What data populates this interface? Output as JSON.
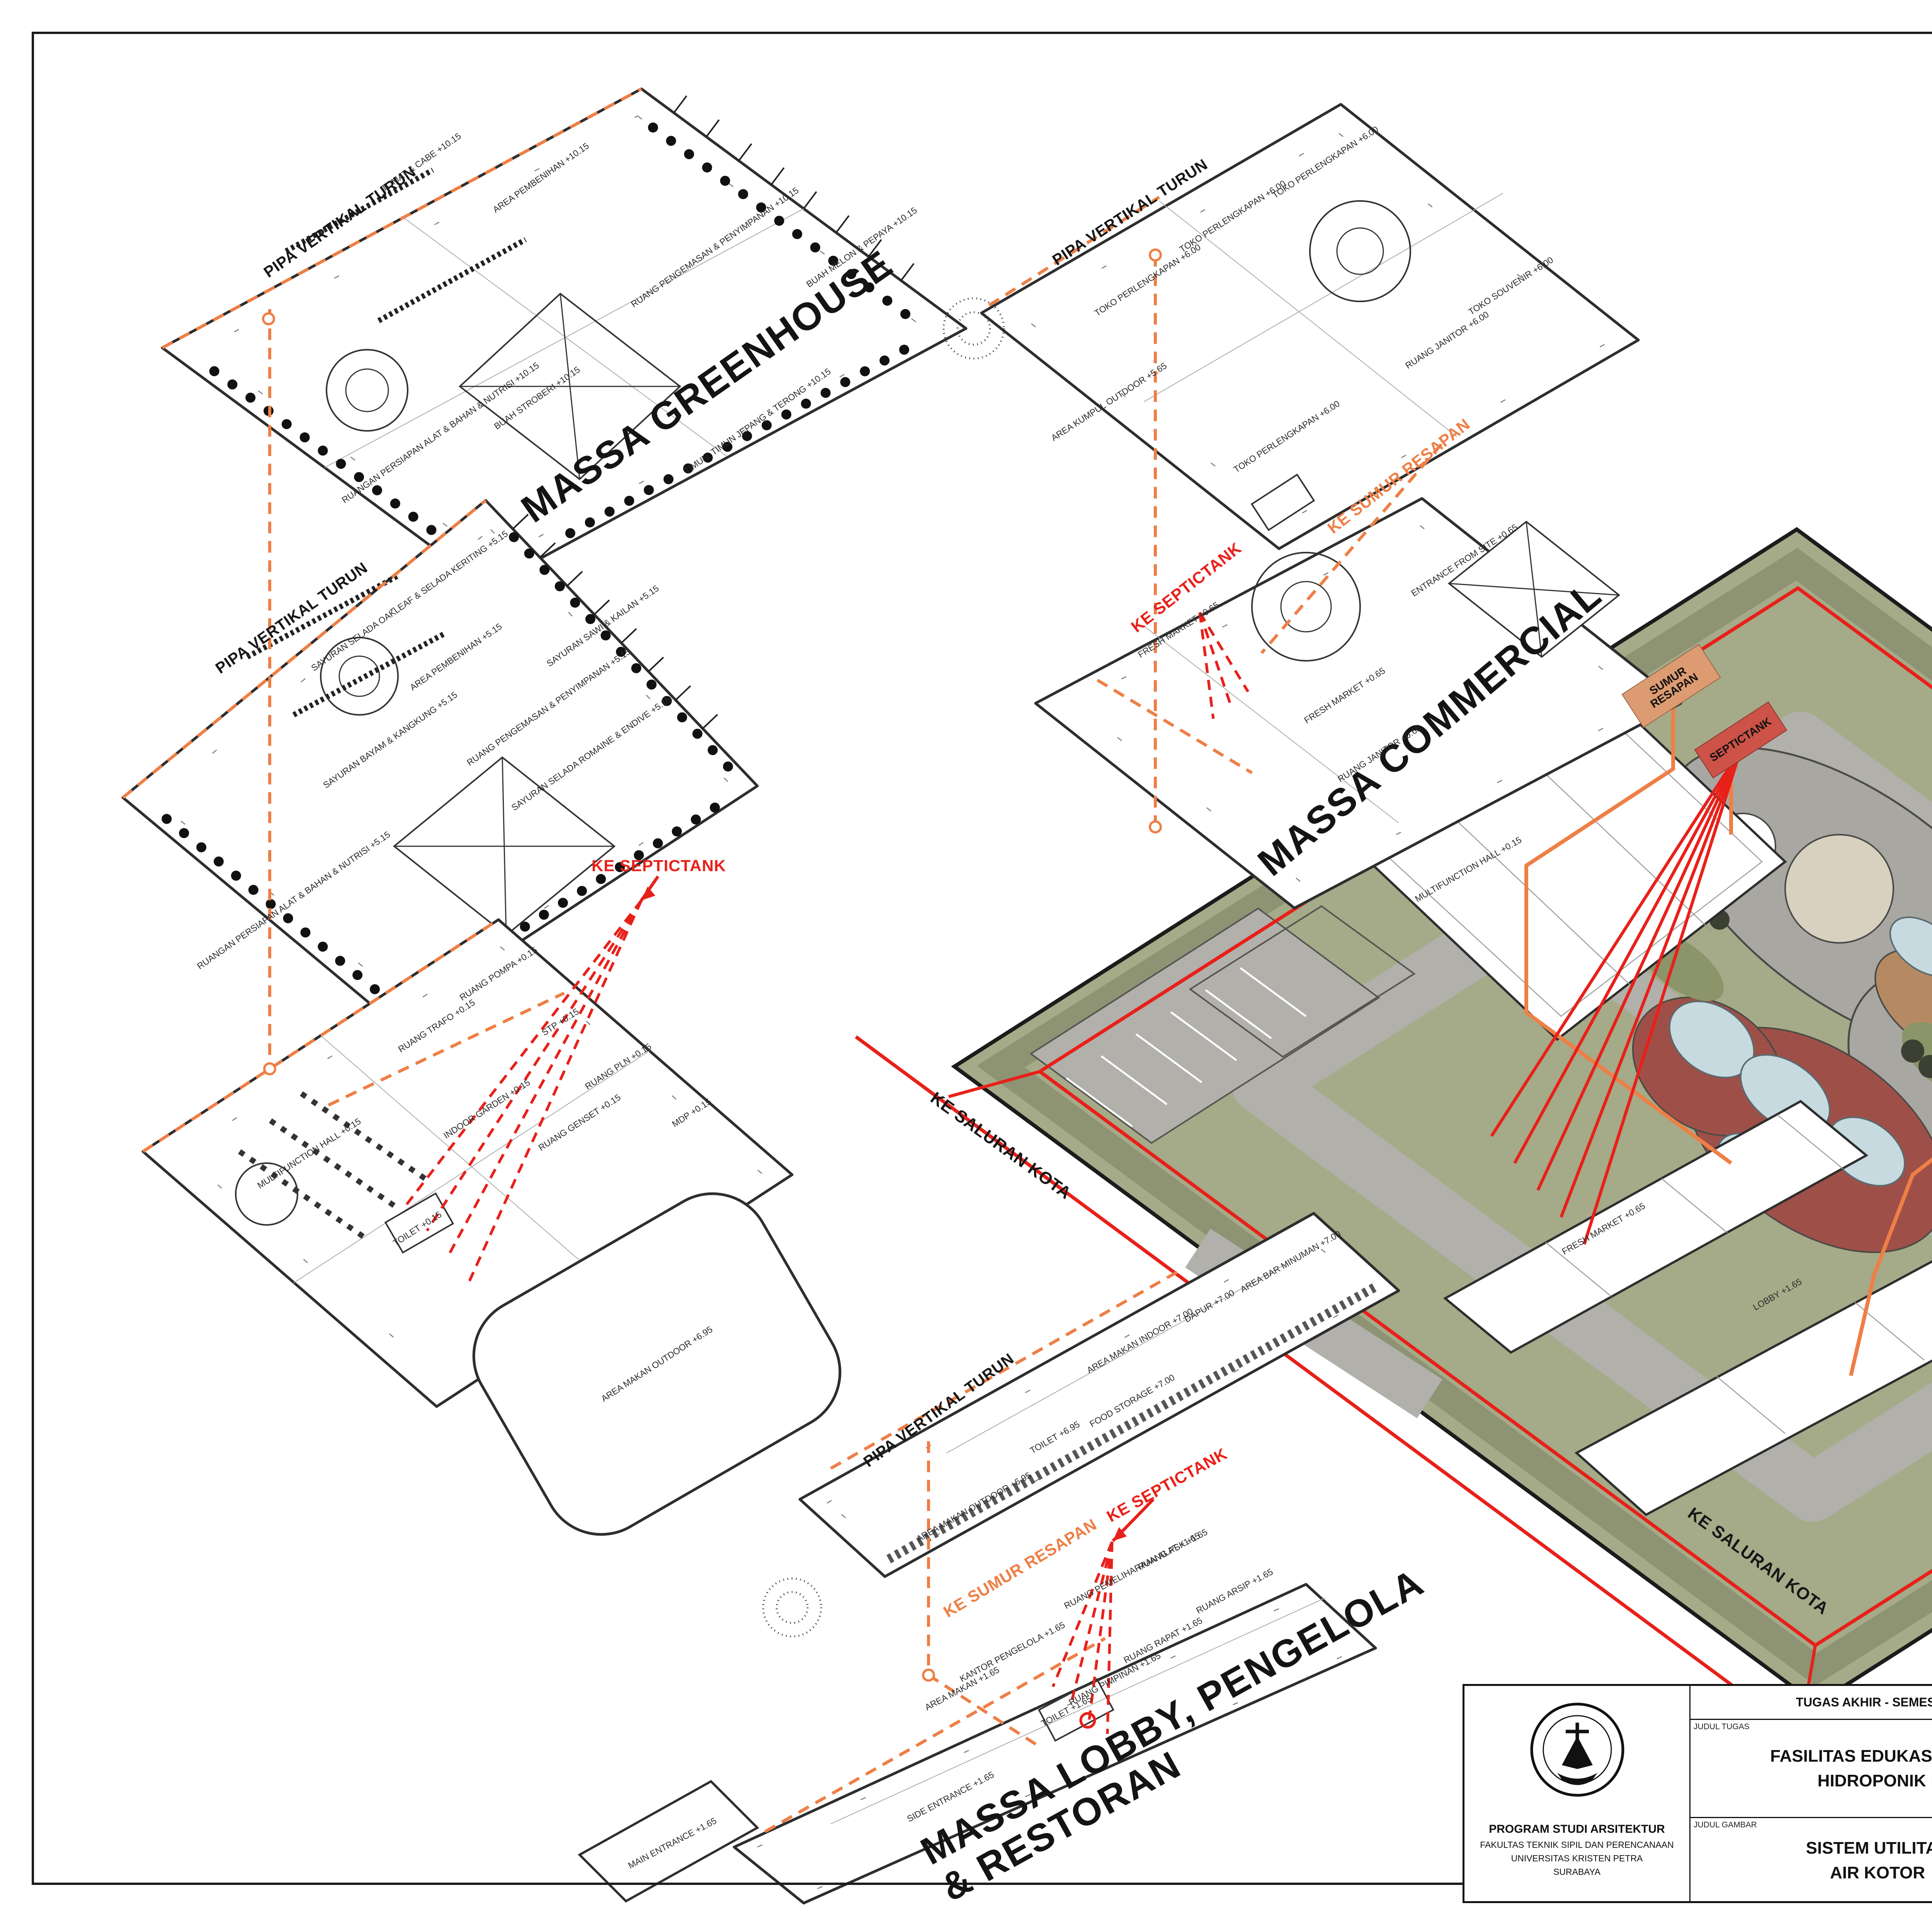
{
  "colors": {
    "accent_red": "#e8201a",
    "accent_orange": "#ee7f46",
    "site_green": "#a5aa88",
    "road_gray": "#b2b0ab",
    "plaza_red": "#9e5048",
    "pond_blue": "#c6dae0",
    "wood_tan": "#b58a63",
    "septictank_fill": "#cd5247",
    "sumur_resapan_fill": "#dd9b72"
  },
  "massa": {
    "greenhouse": "MASSA GREENHOUSE",
    "commercial": "MASSA COMMERCIAL",
    "hidroponik_line1": "MASSA HIDROPONIK",
    "hidroponik_line2": "EDUCATION",
    "lobby_line1": "MASSA LOBBY, PENGELOLA",
    "lobby_line2": "& RESTORAN"
  },
  "annotations": {
    "pipa_vertikal_turun": "PIPA VERTIKAL TURUN",
    "ke_septictank": "KE SEPTICTANK",
    "ke_sumur_resapan": "KE SUMUR RESAPAN",
    "ke_saluran_kota": "KE SALURAN KOTA",
    "septictank_box": "SEPTICTANK",
    "sumur_resapan_box": "SUMUR RESAPAN"
  },
  "plans": {
    "greenhouse_roof": {
      "rooms": [
        "RUANG PENGEMASAN & PENYIMPANAN +10.15",
        "RUANGAN PERSIAPAN ALAT & BAHAN & NUTRISI +10.15",
        "AREA PEMBENIHAN +10.15",
        "TOMAT & CABE +10.15",
        "TIMUN, TIMUN JEPANG & TERONG +10.15",
        "BUAH MELON & PEPAYA +10.15",
        "BUAH STROBERI +10.15"
      ]
    },
    "greenhouse_l2": {
      "rooms": [
        "RUANG PENGEMASAN & PENYIMPANAN +5.15",
        "RUANGAN PERSIAPAN ALAT & BAHAN & NUTRISI +5.15",
        "AREA PEMBENIHAN +5.15",
        "SAYURAN SELADA OAKLEAF & SELADA KERITING +5.15",
        "SAYURAN SAWI & KAILAN +5.15",
        "SAYURAN SELADA ROMAINE & ENDIVE +5.15",
        "SAYURAN BAYAM & KANGKUNG +5.15"
      ]
    },
    "greenhouse_l1": {
      "rooms": [
        "MULTIFUNCTION HALL +0.15",
        "INDOOR GARDEN +0.15",
        "RUANG POMPA +0.15",
        "STP +0.15",
        "RUANG TRAFO +0.15",
        "RUANG PLN +0.15",
        "MDP +0.15",
        "RUANG GENSET +0.15",
        "TOILET +0.15"
      ]
    },
    "commercial_l2": {
      "rooms": [
        "TOKO PERLENGKAPAN +6.00",
        "TOKO PERLENGKAPAN +6.00",
        "TOKO PERLENGKAPAN +6.00",
        "TOKO PERLENGKAPAN +6.00",
        "TOKO SOUVENIR +6.00",
        "RUANG JANITOR +6.00",
        "AREA KUMPUL OUTDOOR +5.65"
      ]
    },
    "commercial_l1": {
      "rooms": [
        "FRESH MARKET +0.65",
        "FRESH MARKET +0.65",
        "ENTRANCE FROM SITE +0.65",
        "RUANG JANITOR +0.65"
      ]
    },
    "education_l2": {
      "rooms": [
        "RUANG HASIL PENELITIAN +4.65",
        "LABORATORIUM +4.65",
        "PERPUSTAKAAN & RUANG BACA +4.65",
        "AHU +4.65"
      ]
    },
    "education_l1": {
      "rooms": [
        "AREA AQUAPONIC +0.15",
        "MINI GARDEN +0.15",
        "RUANG JANITOR +0.15",
        "GUDANG +0.15",
        "PERPUSTAKAAN & RUANG BACA +0.15",
        "TOILET +0.15",
        "AHU +0.15",
        "BUILDING ENTRANCE & EXIT +0.10"
      ]
    },
    "resto_l2": {
      "rooms": [
        "AREA MAKAN OUTDOOR +6.95",
        "AREA MAKAN INDOOR +7.00",
        "DAPUR +7.00",
        "AREA BAR MINUMAN +7.00",
        "FOOD STORAGE +7.00",
        "TOILET +6.95",
        "AREA MAKAN OUTDOOR +6.95"
      ]
    },
    "lobby_l1": {
      "rooms": [
        "RUANG PSK +1.65",
        "RUANG PEMELIHARAAN ALAT +1.65",
        "RUANG ARSIP +1.65",
        "RUANG RAPAT +1.65",
        "RUANG PIMPINAN +1.65",
        "KANTOR PENGELOLA +1.65",
        "AREA MAKAN +1.65",
        "TOILET +1.65",
        "SIDE ENTRANCE +1.65",
        "MAIN ENTRANCE +1.65"
      ]
    }
  },
  "site": {
    "labels": [
      "LOBBY +1.65",
      "FRESH MARKET +0.65",
      "MULTIFUNCTION HALL +0.15",
      "BUILDING ENTRANCE & EXIT +0.10"
    ]
  },
  "titleblock": {
    "header": "TUGAS AKHIR - SEMESTER GENAP 2023/2024",
    "judul_tugas_label": "JUDUL TUGAS",
    "judul_tugas_line1": "FASILITAS EDUKASI WISATA TANAMAN",
    "judul_tugas_line2": "HIDROPONIK DI PASURUAN",
    "judul_gambar_label": "JUDUL GAMBAR",
    "judul_gambar_line1": "SISTEM UTILITAS",
    "judul_gambar_line2": "AIR KOTOR",
    "skala_label": "SKALA",
    "nama_label": "NAMA",
    "nama_value": "GERALDO ALVIN SOECIPTO",
    "nrp_label": "NRP",
    "nrp_value": "B12200040",
    "kelompok_label": "KELOMPOK",
    "kelompok_value": "4",
    "mentor_utama_label": "MENTOR UTAMA",
    "mentor_utama_value": "Dr. FENY ELSIANA, S.T., M.T.",
    "mentor_pendamping_label": "MENTOR PENDAMPING",
    "mentor_pendamping_value1": "ANGELA CHRISTYSONIA TAMPUBOLON, S.T., M.T.",
    "mentor_pendamping_value2": "IR. HANDINOTO, M.T.",
    "lembar_label": "LEMBAR",
    "jumlah_label": "JUMLAH",
    "tanggal_label": "TANGGAL",
    "pengesahan_label": "PENGESAHAN",
    "institution_line1": "PROGRAM STUDI ARSITEKTUR",
    "institution_line2": "FAKULTAS TEKNIK SIPIL DAN PERENCANAAN",
    "institution_line3": "UNIVERSITAS KRISTEN PETRA",
    "institution_line4": "SURABAYA",
    "logo_text": "PETRA"
  }
}
